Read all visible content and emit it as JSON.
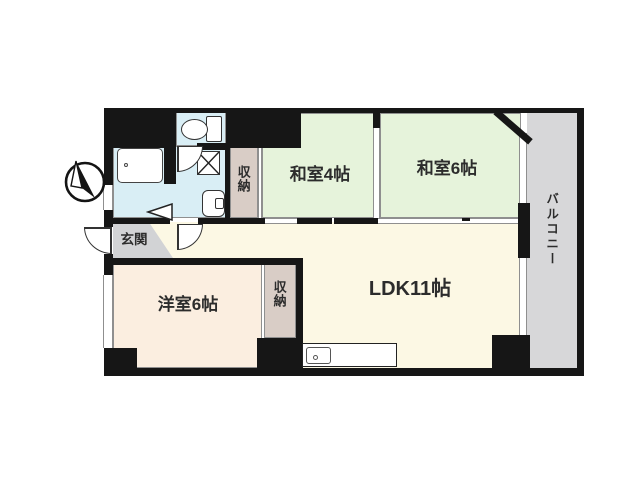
{
  "title": "apartment-floor-plan",
  "colors": {
    "wall": "#161616",
    "line": "#8f8f8f",
    "tatami": "#e6f3db",
    "ldk": "#fcf8e4",
    "western": "#fbeee0",
    "closet": "#d9cdc6",
    "entrance": "#d2d3d5",
    "balcony": "#d7d7d9",
    "wet": "#d9eef5",
    "text": "#2c2c2c"
  },
  "rooms": {
    "washitsu4": {
      "label": "和室4帖"
    },
    "washitsu6": {
      "label": "和室6帖"
    },
    "ldk": {
      "label": "LDK11帖"
    },
    "western6": {
      "label": "洋室6帖"
    },
    "closet_upper": {
      "label": "収納"
    },
    "closet_lower": {
      "label": "収納"
    },
    "entrance": {
      "label": "玄関"
    },
    "balcony": {
      "label": "バルコニー"
    }
  },
  "icons": {
    "compass": "north-arrow",
    "toilet": "toilet",
    "bathtub": "bathtub",
    "washing_machine": "washing-machine-cross-square",
    "washbasin": "washbasin",
    "kitchen_sink": "kitchen-counter-sink",
    "door_swing": "quarter-circle-door-swing",
    "folding_door": "triangle-folding-door"
  }
}
